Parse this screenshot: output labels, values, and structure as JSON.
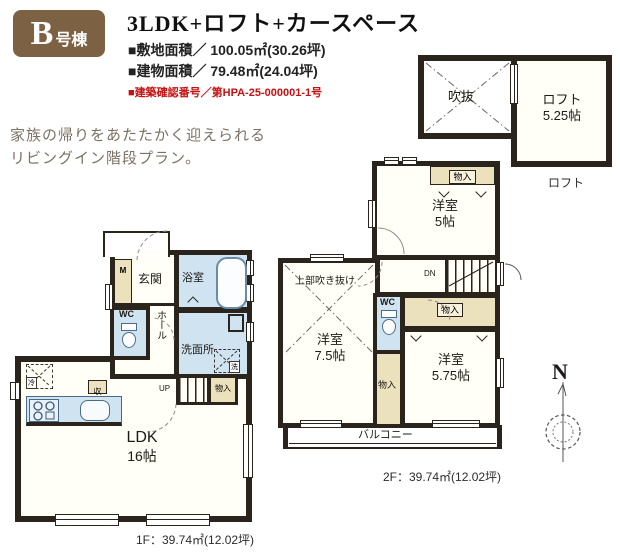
{
  "header": {
    "badge_letter": "B",
    "badge_suffix": "号棟",
    "title": "3LDK+ロフト+カースペース",
    "line_site": "■敷地面積／ 100.05㎡(30.26坪)",
    "line_building": "■建物面積／ 79.48㎡(24.04坪)",
    "line_permit": "■建築確認番号／第HPA-25-000001-1号"
  },
  "tagline": {
    "line1": "家族の帰りをあたたかく迎えられる",
    "line2": "リビングイン階段プラン。"
  },
  "loft_plan": {
    "void_label": "吹抜",
    "loft_label": "ロフト",
    "loft_size": "5.25帖",
    "caption": "ロフト"
  },
  "floor2": {
    "room5": "洋室",
    "room5_size": "5帖",
    "room75": "洋室",
    "room75_size": "7.5帖",
    "room575": "洋室",
    "room575_size": "5.75帖",
    "void_above": "上部吹き抜け",
    "wc": "WC",
    "dn": "DN",
    "closet_top": "物入",
    "closet_mid": "物入",
    "closet_right": "物入",
    "balcony": "バルコニー",
    "caption": "2F：39.74㎡(12.02坪)"
  },
  "floor1": {
    "entrance": "玄関",
    "bath": "浴室",
    "wc": "WC",
    "hall": "ホール",
    "washroom": "洗面所",
    "washer": "洗",
    "meter": "M",
    "up": "UP",
    "closet": "物入",
    "storage": "収",
    "fridge": "冷",
    "ldk": "LDK",
    "ldk_size": "16帖",
    "caption": "1F：39.74㎡(12.02坪)"
  },
  "compass": {
    "north": "N"
  },
  "colors": {
    "wall": "#2b241d",
    "wet_blue": "#cfe3f0",
    "closet_beige": "#ebe1bd",
    "badge_brown": "#7d6143",
    "permit_red": "#c51111"
  }
}
